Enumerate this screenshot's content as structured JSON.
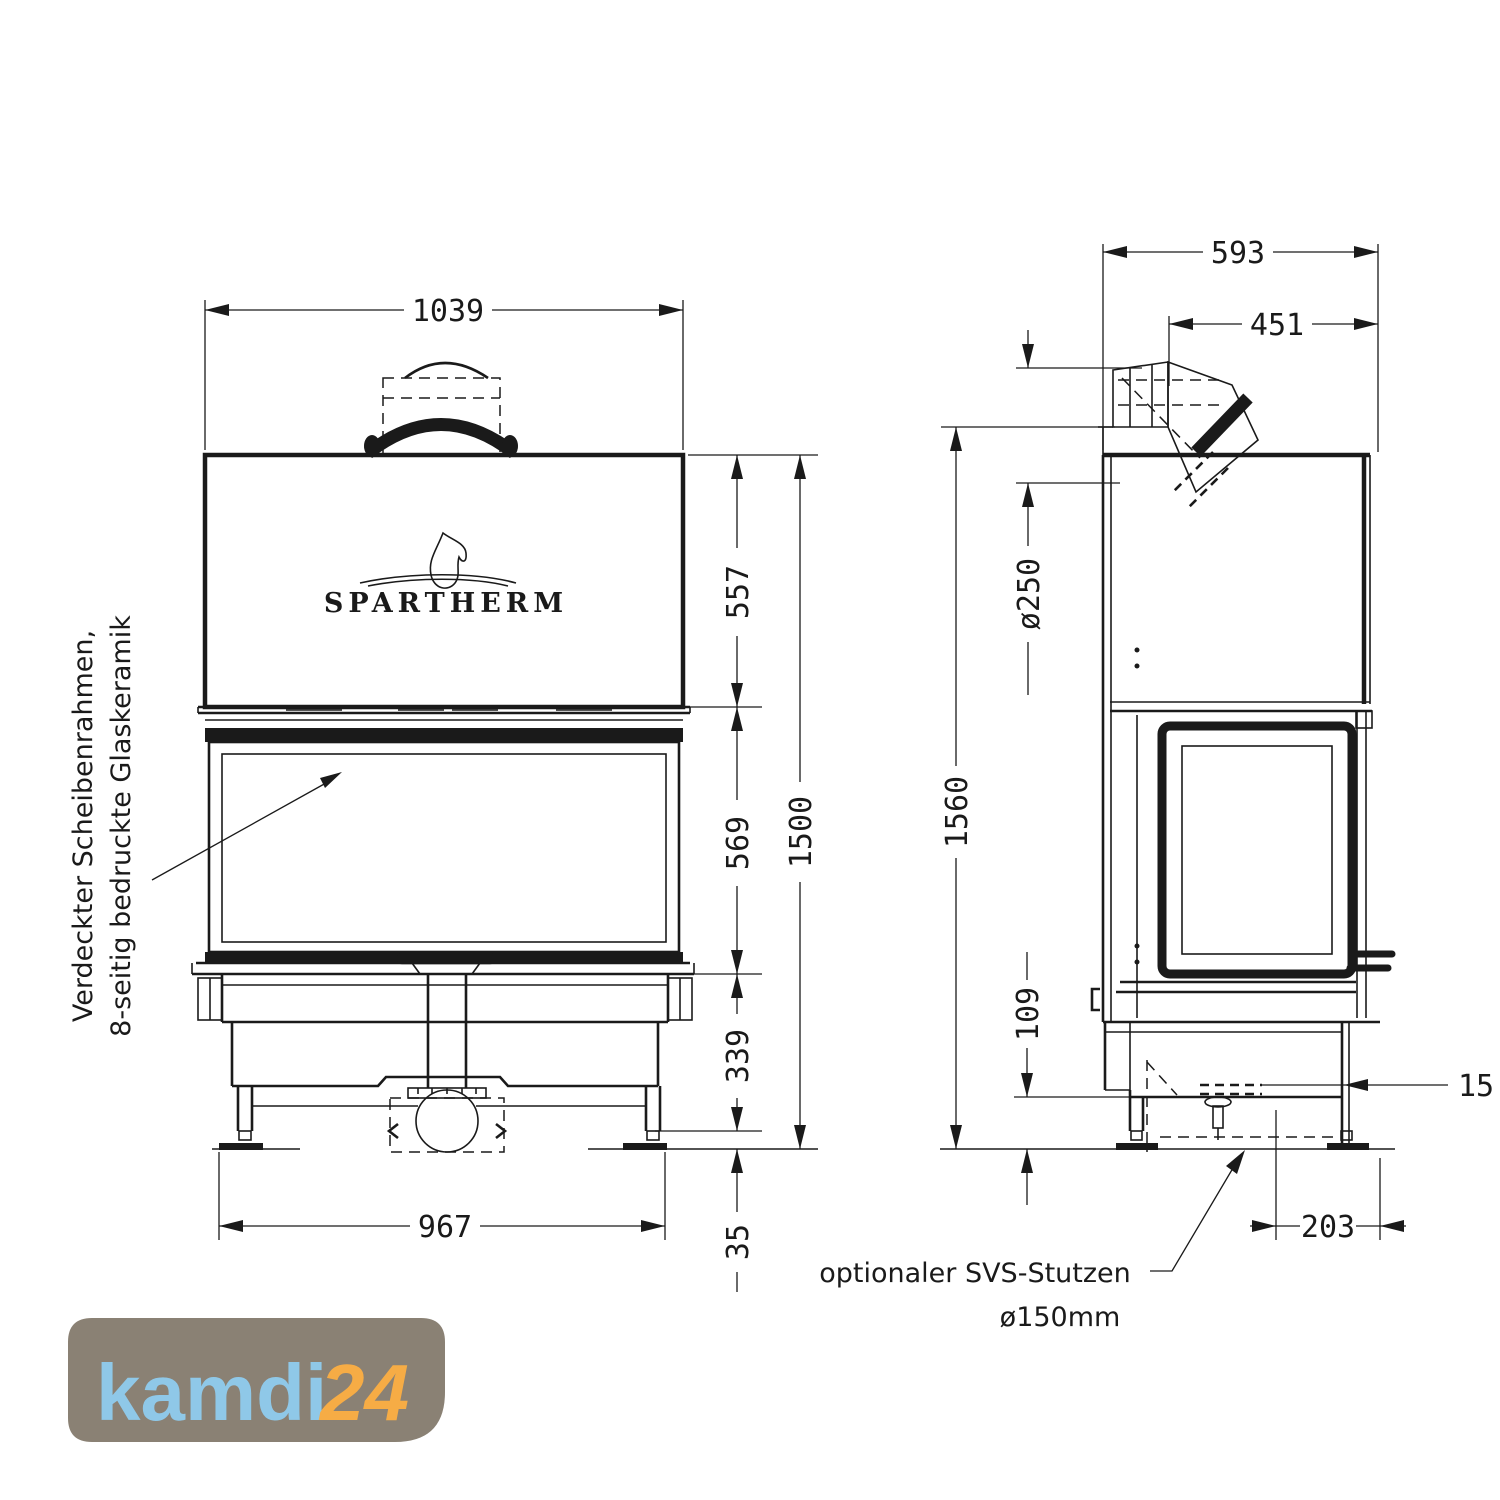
{
  "front": {
    "dim_width_top": "1039",
    "dim_hood_height": "557",
    "dim_door_height": "569",
    "dim_base_height": "339",
    "dim_feet_height": "35",
    "dim_total_height": "1500",
    "dim_width_bottom": "967",
    "brand": "SPARTHERM",
    "note_line1": "Verdeckter Scheibenrahmen,",
    "note_line2": "8-seitig bedruckte Glaskeramik"
  },
  "side": {
    "dim_depth_total": "593",
    "dim_flue_offset": "451",
    "dim_flue_diameter": "ø250",
    "dim_total_height": "1560",
    "dim_base_clearance": "109",
    "dim_panel_thickness": "15",
    "dim_svs_offset": "203",
    "note_line1": "optionaler SVS-Stutzen",
    "note_line2": "ø150mm"
  },
  "logo": {
    "name": "kamdi",
    "number": "24",
    "bg_color": "#8a8174",
    "name_color": "#8fc8e8",
    "number_color": "#f6ac45"
  },
  "colors": {
    "line": "#1a1a1a",
    "background": "#ffffff"
  }
}
